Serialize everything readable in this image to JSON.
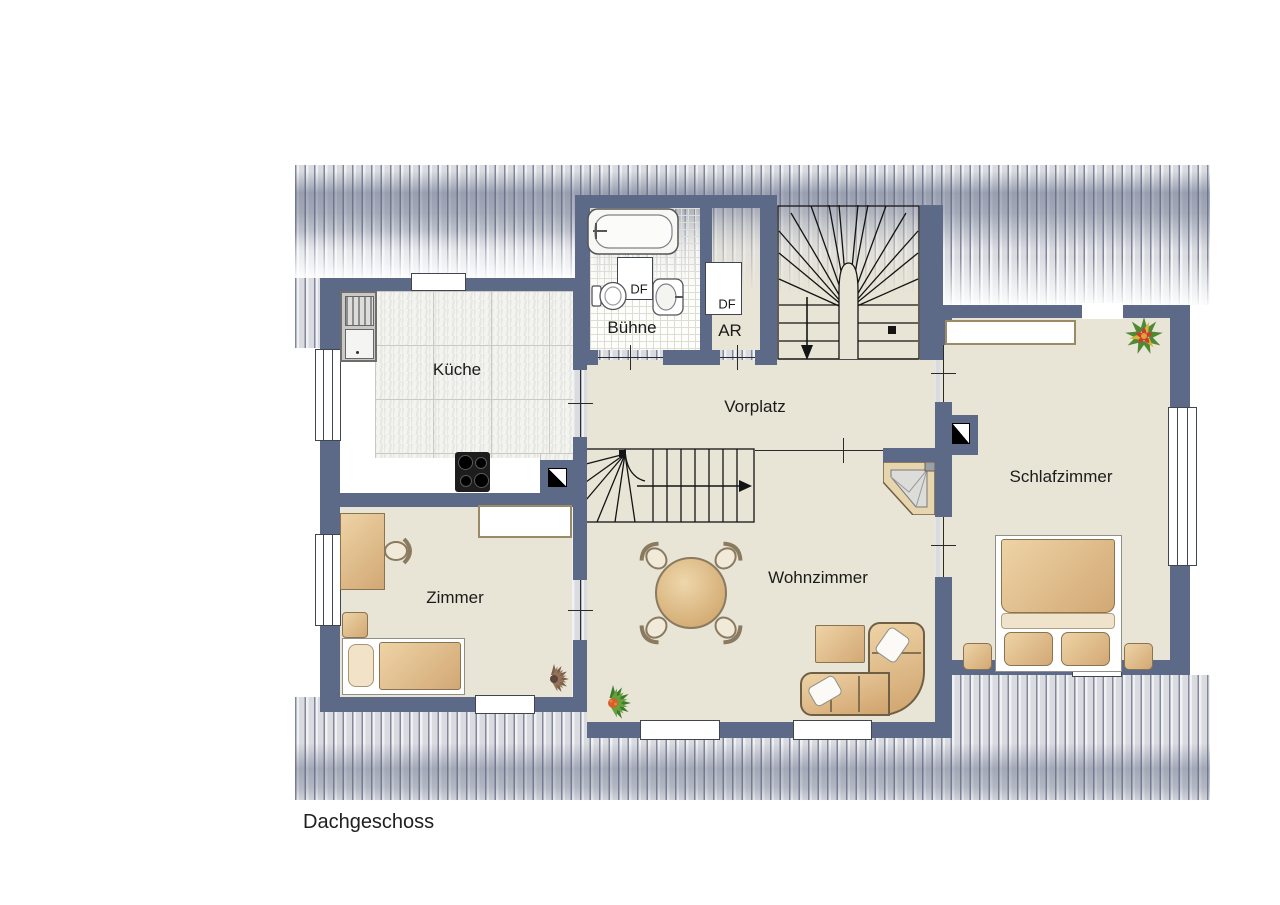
{
  "page": {
    "floor_label": "Dachgeschoss"
  },
  "rooms": {
    "kueche": "Küche",
    "buehne": "Bühne",
    "abstellraum": "AR",
    "vorplatz": "Vorplatz",
    "zimmer": "Zimmer",
    "wohnzimmer": "Wohnzimmer",
    "schlafzimmer": "Schlafzimmer"
  },
  "roof_windows": {
    "buehne": "DF",
    "abstellraum": "DF"
  },
  "colors": {
    "wall": "#5c6a88",
    "floor": "#e8e4d6",
    "kitchen_tile": "#f3f3ef",
    "bath_tile": "#fdfdfb",
    "furniture_wood": "#dcba8a",
    "roof_hatch_dark": "#82889a",
    "roof_hatch_light": "#f0f1f3",
    "plant_green": "#4e8a33",
    "plant_brown": "#7d6049",
    "flower_red": "#cc3d2e"
  }
}
